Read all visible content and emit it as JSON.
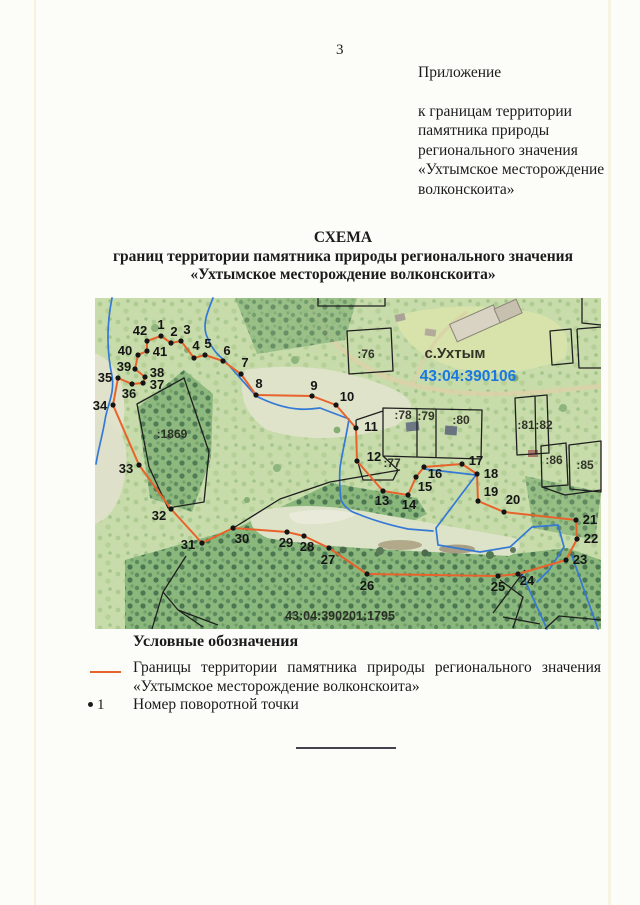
{
  "page": {
    "number": "3",
    "appendix_label": "Приложение",
    "appendix_lines": [
      "к границам территории",
      "памятника природы",
      "регионального значения",
      "«Ухтымское месторождение",
      "волконскоита»"
    ],
    "title_line1": "СХЕМА",
    "title_line2": "границ территории памятника природы регионального значения",
    "title_line3": "«Ухтымское месторождение волконскоита»"
  },
  "map": {
    "colors": {
      "boundary": "#e8632c",
      "stream": "#3579d6",
      "cadastral_blue": "#1b78e0",
      "parcel_line": "#1f1f1f",
      "point_dot": "#141414"
    },
    "settlement_label": "с.Ухтым",
    "cadastral_quarter": "43:04:390106",
    "cadastral_parcel": "43:04:390201:1795",
    "labels": [
      {
        "text": "с.Ухтым",
        "x": 360,
        "y": 60,
        "size": 15,
        "color": "black"
      },
      {
        "text": "43:04:390106",
        "x": 373,
        "y": 83,
        "size": 15.5,
        "color": "blue"
      },
      {
        "text": ":76",
        "x": 271,
        "y": 60,
        "size": 12,
        "color": "black"
      },
      {
        "text": ":78",
        "x": 308,
        "y": 121,
        "size": 12,
        "color": "black"
      },
      {
        "text": ":79",
        "x": 331,
        "y": 122,
        "size": 12,
        "color": "black"
      },
      {
        "text": ":80",
        "x": 366,
        "y": 126,
        "size": 12,
        "color": "black"
      },
      {
        "text": ":81",
        "x": 431,
        "y": 131,
        "size": 12,
        "color": "black"
      },
      {
        "text": ":82",
        "x": 449,
        "y": 131,
        "size": 12,
        "color": "black"
      },
      {
        "text": ":86",
        "x": 459,
        "y": 166,
        "size": 12,
        "color": "black"
      },
      {
        "text": ":85",
        "x": 490,
        "y": 171,
        "size": 12,
        "color": "black"
      },
      {
        "text": ":77",
        "x": 297,
        "y": 169,
        "size": 12,
        "color": "black"
      },
      {
        "text": ":1869",
        "x": 77,
        "y": 140,
        "size": 12,
        "color": "black"
      },
      {
        "text": "43:04:390201:1795",
        "x": 245,
        "y": 322,
        "size": 12.5,
        "color": "black"
      }
    ],
    "points": [
      {
        "n": "1",
        "x": 66,
        "y": 38,
        "lx": 66,
        "ly": 31
      },
      {
        "n": "2",
        "x": 76,
        "y": 45,
        "lx": 79,
        "ly": 38
      },
      {
        "n": "3",
        "x": 86,
        "y": 43,
        "lx": 92,
        "ly": 36
      },
      {
        "n": "4",
        "x": 99,
        "y": 60,
        "lx": 101,
        "ly": 52
      },
      {
        "n": "5",
        "x": 110,
        "y": 57,
        "lx": 113,
        "ly": 50
      },
      {
        "n": "6",
        "x": 128,
        "y": 63,
        "lx": 132,
        "ly": 57
      },
      {
        "n": "7",
        "x": 146,
        "y": 76,
        "lx": 150,
        "ly": 69
      },
      {
        "n": "8",
        "x": 161,
        "y": 97,
        "lx": 164,
        "ly": 90
      },
      {
        "n": "9",
        "x": 217,
        "y": 98,
        "lx": 219,
        "ly": 92
      },
      {
        "n": "10",
        "x": 241,
        "y": 107,
        "lx": 252,
        "ly": 103
      },
      {
        "n": "11",
        "x": 261,
        "y": 130,
        "lx": 276,
        "ly": 133
      },
      {
        "n": "12",
        "x": 262,
        "y": 163,
        "lx": 279,
        "ly": 163
      },
      {
        "n": "13",
        "x": 288,
        "y": 193,
        "lx": 287,
        "ly": 207
      },
      {
        "n": "14",
        "x": 313,
        "y": 197,
        "lx": 314,
        "ly": 211
      },
      {
        "n": "15",
        "x": 321,
        "y": 179,
        "lx": 330,
        "ly": 193
      },
      {
        "n": "16",
        "x": 329,
        "y": 169,
        "lx": 340,
        "ly": 180
      },
      {
        "n": "17",
        "x": 367,
        "y": 166,
        "lx": 381,
        "ly": 167
      },
      {
        "n": "18",
        "x": 382,
        "y": 176,
        "lx": 396,
        "ly": 180
      },
      {
        "n": "19",
        "x": 383,
        "y": 203,
        "lx": 396,
        "ly": 198
      },
      {
        "n": "20",
        "x": 409,
        "y": 214,
        "lx": 418,
        "ly": 206
      },
      {
        "n": "21",
        "x": 481,
        "y": 222,
        "lx": 495,
        "ly": 226
      },
      {
        "n": "22",
        "x": 482,
        "y": 241,
        "lx": 496,
        "ly": 245
      },
      {
        "n": "23",
        "x": 471,
        "y": 262,
        "lx": 485,
        "ly": 266
      },
      {
        "n": "24",
        "x": 423,
        "y": 276,
        "lx": 432,
        "ly": 287
      },
      {
        "n": "25",
        "x": 403,
        "y": 278,
        "lx": 403,
        "ly": 293
      },
      {
        "n": "26",
        "x": 272,
        "y": 276,
        "lx": 272,
        "ly": 292
      },
      {
        "n": "27",
        "x": 234,
        "y": 250,
        "lx": 233,
        "ly": 266
      },
      {
        "n": "28",
        "x": 209,
        "y": 238,
        "lx": 212,
        "ly": 253
      },
      {
        "n": "29",
        "x": 192,
        "y": 234,
        "lx": 191,
        "ly": 249
      },
      {
        "n": "30",
        "x": 138,
        "y": 230,
        "lx": 147,
        "ly": 245
      },
      {
        "n": "31",
        "x": 107,
        "y": 245,
        "lx": 93,
        "ly": 251
      },
      {
        "n": "32",
        "x": 76,
        "y": 211,
        "lx": 64,
        "ly": 222
      },
      {
        "n": "33",
        "x": 44,
        "y": 167,
        "lx": 31,
        "ly": 175
      },
      {
        "n": "34",
        "x": 18,
        "y": 107,
        "lx": 5,
        "ly": 112
      },
      {
        "n": "35",
        "x": 23,
        "y": 80,
        "lx": 10,
        "ly": 84
      },
      {
        "n": "36",
        "x": 37,
        "y": 86,
        "lx": 34,
        "ly": 100
      },
      {
        "n": "37",
        "x": 48,
        "y": 85,
        "lx": 62,
        "ly": 91
      },
      {
        "n": "38",
        "x": 50,
        "y": 79,
        "lx": 62,
        "ly": 79
      },
      {
        "n": "39",
        "x": 40,
        "y": 71,
        "lx": 29,
        "ly": 73
      },
      {
        "n": "40",
        "x": 43,
        "y": 57,
        "lx": 30,
        "ly": 57
      },
      {
        "n": "41",
        "x": 52,
        "y": 53,
        "lx": 65,
        "ly": 58
      },
      {
        "n": "42",
        "x": 52,
        "y": 43,
        "lx": 45,
        "ly": 37
      }
    ]
  },
  "legend": {
    "header": "Условные обозначения",
    "boundary_item": {
      "line1": "Границы территории памятника природы регионального значения",
      "line2": "«Ухтымское месторождение волконскоита»"
    },
    "point_item": {
      "number": "1",
      "label": "Номер поворотной точки"
    }
  }
}
